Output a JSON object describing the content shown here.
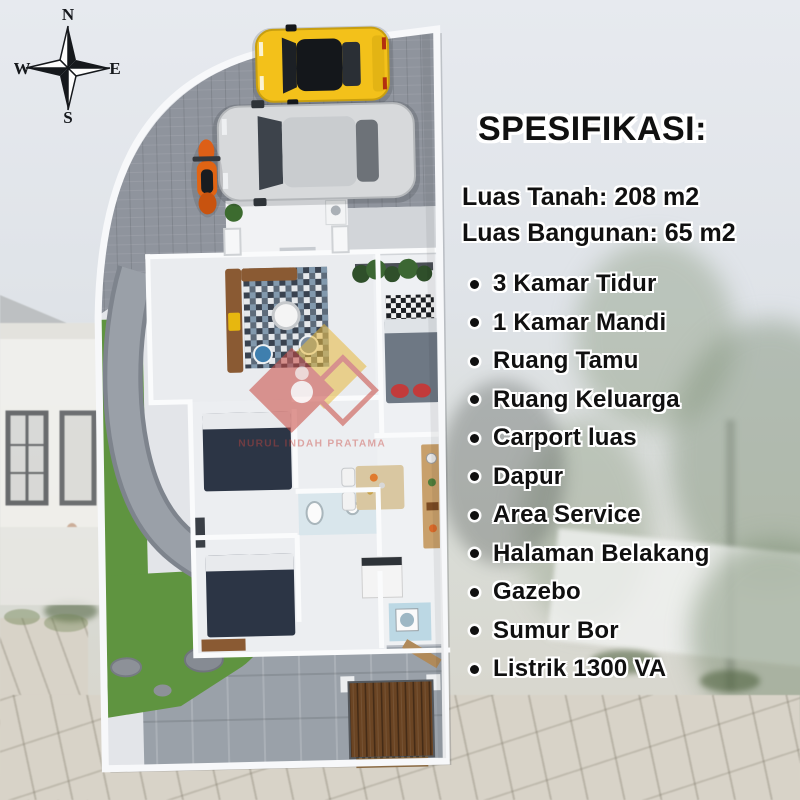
{
  "compass": {
    "n": "N",
    "e": "E",
    "s": "S",
    "w": "W"
  },
  "specs": {
    "title": "SPESIFIKASI:",
    "land_area": "Luas Tanah: 208 m2",
    "building_area": "Luas Bangunan: 65 m2",
    "features": [
      "3 Kamar Tidur",
      "1 Kamar Mandi",
      "Ruang Tamu",
      "Ruang Keluarga",
      "Carport luas",
      "Dapur",
      "Area Service",
      "Halaman Belakang",
      "Gazebo",
      "Sumur Bor",
      "Listrik 1300 VA"
    ]
  },
  "watermark": {
    "text": "NURUL INDAH PRATAMA"
  },
  "plan_objects": [
    "compass-rose",
    "carport",
    "yellow-car",
    "silver-car",
    "motorbike",
    "entrance-terrace",
    "living-room-sofa",
    "living-room-rug",
    "master-bed",
    "bedroom-bed-1",
    "bedroom-bed-2",
    "bathroom",
    "dining-table",
    "kitchen-counter",
    "garden-grass",
    "garden-path",
    "backyard",
    "gazebo-deck",
    "watermark-logo"
  ],
  "palette": {
    "ink": "#101010",
    "outline": "#ffffff",
    "car_yellow": "#f3c11a",
    "grass": "#5f9440",
    "carport_gray": "#8f949d",
    "wall_white": "#fafbfc",
    "gazebo_brown": "#6a4423",
    "bed_navy": "#2c3545",
    "wm_red": "#c8473f",
    "wm_yellow": "#e8b93c"
  }
}
